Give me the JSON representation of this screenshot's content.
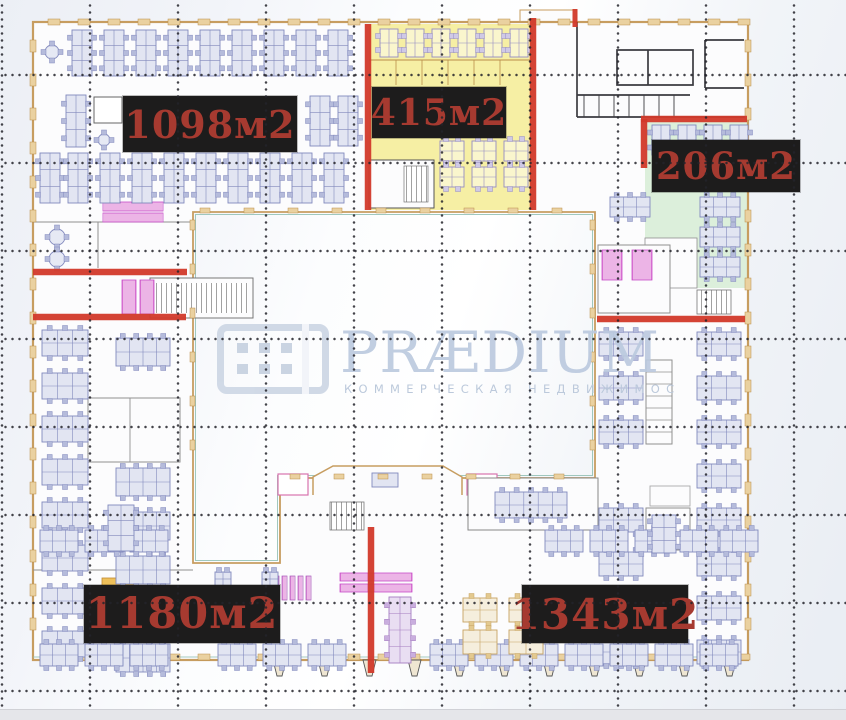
{
  "meta": {
    "type": "floor-plan",
    "units": "м2"
  },
  "watermark": {
    "brand": "PRÆDIUM",
    "tagline": "КОММЕРЧЕСКАЯ НЕДВИЖИМОСТЬ"
  },
  "areas": [
    {
      "id": "zone-top-left",
      "label": "1098м2",
      "highlight": "none"
    },
    {
      "id": "zone-top-center",
      "label": "415м2",
      "highlight": "#f6efa4"
    },
    {
      "id": "zone-right",
      "label": "206м2",
      "highlight": "#dcefdb"
    },
    {
      "id": "zone-bottom-left",
      "label": "1180м2",
      "highlight": "none"
    },
    {
      "id": "zone-bottom-right",
      "label": "1343м2",
      "highlight": "none"
    }
  ],
  "colors": {
    "divider_red": "#d23a2b",
    "label_bg": "#1d1c1c",
    "label_text": "#a63a30",
    "highlight_yellow": "#f6efa4",
    "highlight_green": "#dcefdb",
    "watermark_blue": "#bccadf"
  }
}
